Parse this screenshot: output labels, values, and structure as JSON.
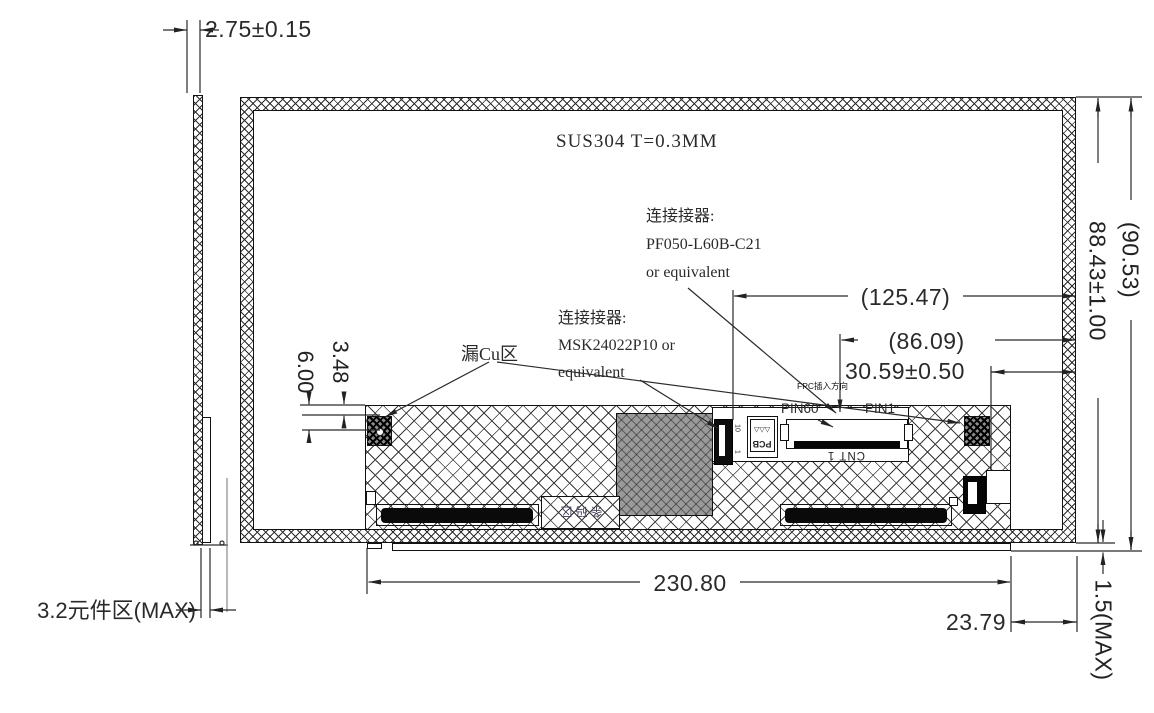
{
  "notes": {
    "material": "SUS304 T=0.3MM"
  },
  "connectors": {
    "c1": {
      "l1": "连接接器:",
      "l2": "PF050-L60B-C21",
      "l3": "or equivalent"
    },
    "c2": {
      "l1": "连接接器:",
      "l2": "MSK24022P10 or",
      "l3": "equivalent"
    }
  },
  "labels": {
    "cu_area": "漏Cu区",
    "fpc_dir": "FPC插入方向",
    "pin60": "PIN60",
    "pin1": "PIN1",
    "cnt1": "CNT 1",
    "pcb": "PCB",
    "pcb_rev": "△△△",
    "sticker": "条码区",
    "pin10": "10",
    "pin1_small": "1",
    "component_area": "3.2元件区(MAX)"
  },
  "dimensions": {
    "thickness": "2.75±0.15",
    "overall_height": "(90.53)",
    "active_height": "88.43±1.00",
    "ref_125": "(125.47)",
    "ref_86": "(86.09)",
    "conn_offset": "30.59±0.50",
    "cu_offset_6": "6.00",
    "cu_offset_348": "3.48",
    "pcb_width": "230.80",
    "right_offset": "23.79",
    "step_max": "1.5(MAX)"
  }
}
